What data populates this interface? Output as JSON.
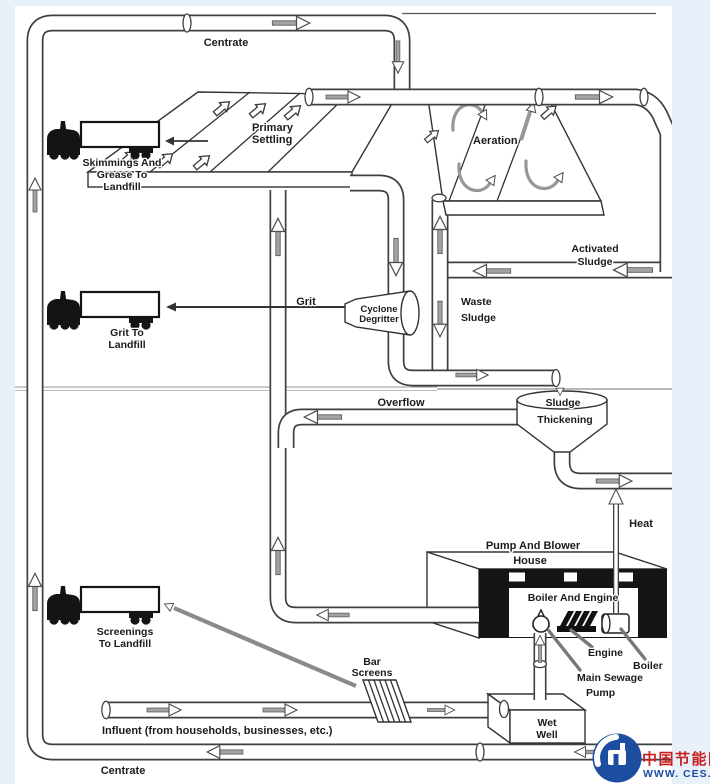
{
  "diagram": {
    "streams": {
      "centrate_top": "Centrate",
      "centrate_bottom": "Centrate",
      "grit": "Grit",
      "overflow": "Overflow",
      "heat": "Heat",
      "activated_sludge": [
        "Activated",
        "Sludge"
      ],
      "waste_sludge": [
        "Waste",
        "Sludge"
      ],
      "influent": "Influent (from households, businesses, etc.)"
    },
    "units": {
      "primary_settling": [
        "Primary",
        "Settling"
      ],
      "aeration": "Aeration",
      "cyclone_degritter": [
        "Cyclone",
        "Degritter"
      ],
      "sludge_thickening": [
        "Sludge",
        "Thickening"
      ],
      "pump_blower_house": [
        "Pump And Blower",
        "House"
      ],
      "boiler_and_engine": "Boiler And Engine",
      "engine": "Engine",
      "boiler": "Boiler",
      "main_sewage_pump": [
        "Main Sewage",
        "Pump"
      ],
      "wet_well": [
        "Wet",
        "Well"
      ],
      "bar_screens": [
        "Bar",
        "Screens"
      ]
    },
    "trucks": {
      "skimmings": [
        "Skimmings And",
        "Grease To",
        "Landfill"
      ],
      "grit": [
        "Grit To",
        "Landfill"
      ],
      "screenings": [
        "Screenings",
        "To Landfill"
      ]
    },
    "watermark": {
      "cn": "中国节能网",
      "url": "WWW. CES. CN"
    }
  },
  "colors": {
    "accent_blue": "#1c4da0",
    "accent_red": "#c61f1f",
    "background": "#e8f0fa"
  }
}
